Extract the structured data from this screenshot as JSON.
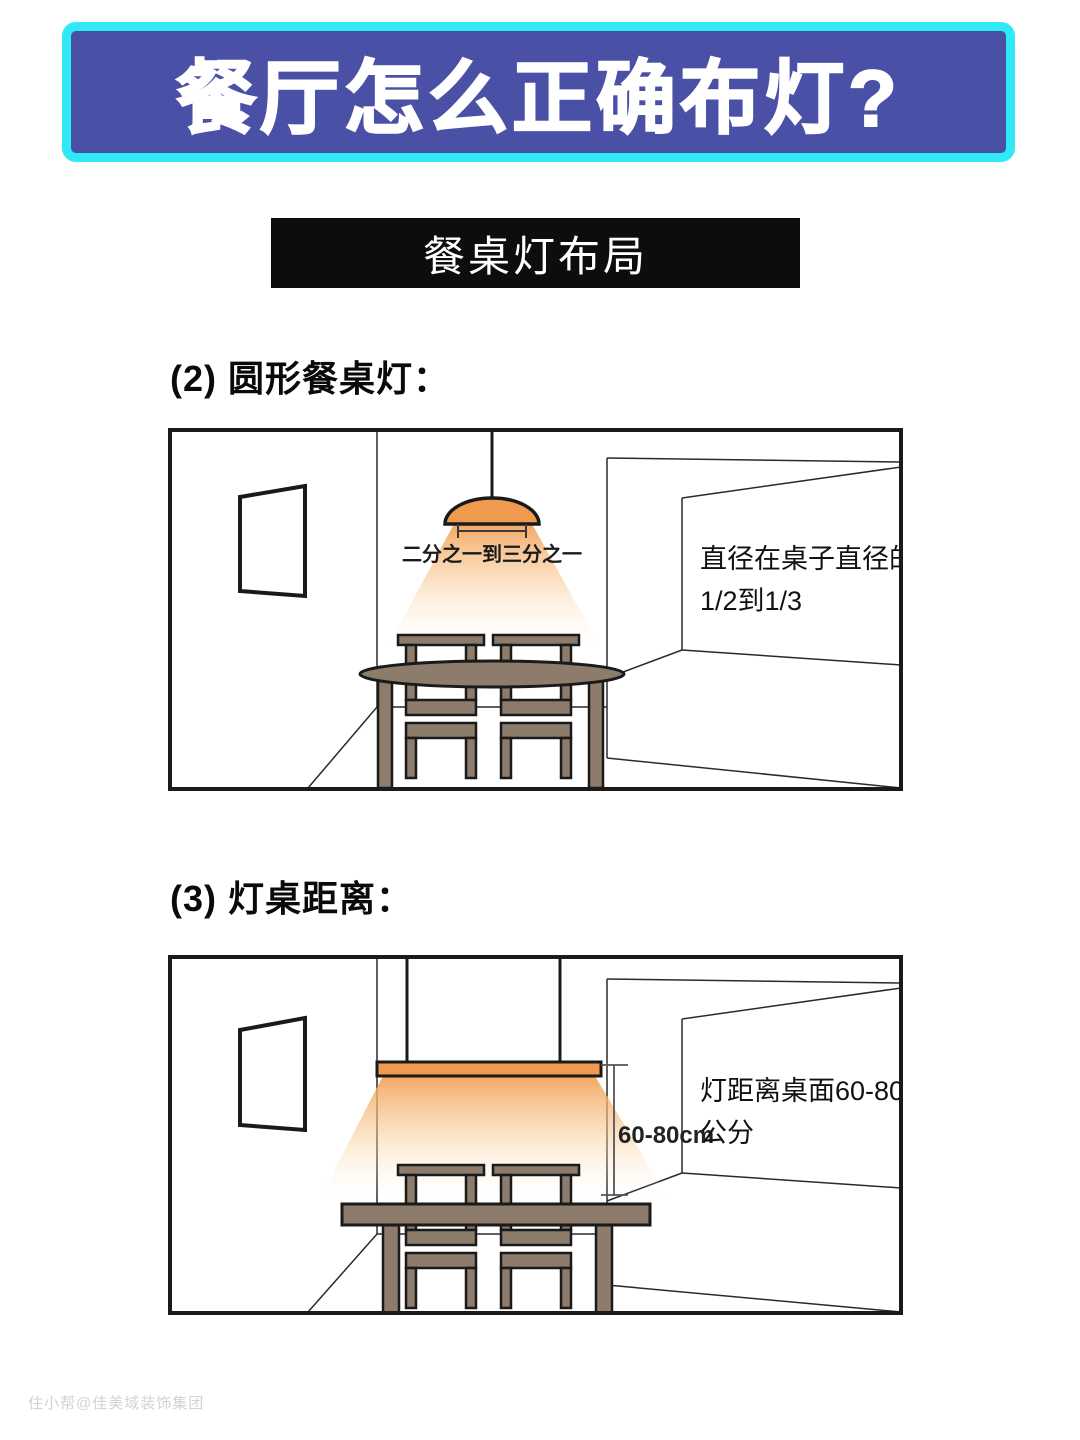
{
  "title_banner": {
    "text": "餐厅怎么正确布灯?",
    "bg_color": "#4950a5",
    "border_color": "#2fe9f6",
    "text_color": "#ffffff"
  },
  "section_banner": {
    "text": "餐桌灯布局",
    "bg_color": "#0d0d0d",
    "text_color": "#ffffff"
  },
  "sections": [
    {
      "heading": "(2) 圆形餐桌灯："
    },
    {
      "heading": "(3) 灯桌距离："
    }
  ],
  "diagram_round": {
    "lamp_width_label": "二分之一到三分之一",
    "note_line1": "直径在桌子直径的",
    "note_line2": "1/2到1/3",
    "lamp_color": "#ef9a4f",
    "glow_color": "#f5b068",
    "wood_color": "#8d7b6b"
  },
  "diagram_distance": {
    "dimension_label": "60-80cm",
    "note_line1": "灯距离桌面60-80",
    "note_line2": "公分",
    "lamp_color": "#ef9a4f",
    "glow_color": "#f5b068",
    "wood_color": "#8d7b6b"
  },
  "watermark": {
    "text": "住小帮@佳美域装饰集团"
  }
}
